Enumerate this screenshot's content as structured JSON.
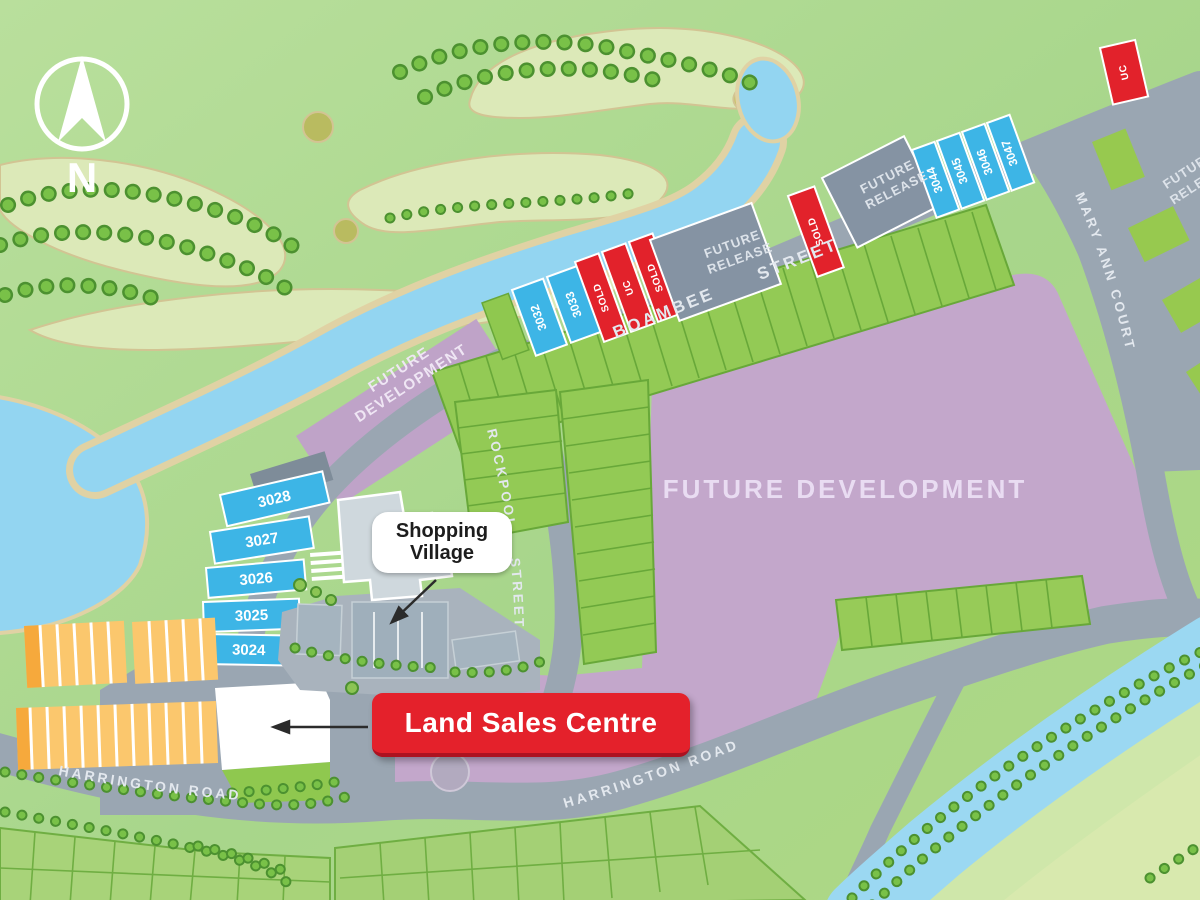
{
  "map": {
    "compass_label": "N",
    "streets": {
      "boambee": "BOAMBEE STREET",
      "mary_ann_court": "MARY ANN COURT",
      "rockpool": "ROCKPOOL STREET",
      "harrington_west": "HARRINGTON ROAD",
      "harrington_east": "HARRINGTON ROAD"
    },
    "areas": {
      "future_development_west": {
        "line1": "FUTURE",
        "line2": "DEVELOPMENT"
      },
      "future_development_main": "FUTURE DEVELOPMENT",
      "future_release_block1": {
        "line1": "FUTURE",
        "line2": "RELEASE"
      },
      "future_release_block2": {
        "line1": "FUTURE",
        "line2": "RELEASE"
      },
      "future_release_edge": {
        "line1": "FUTURE",
        "line2": "RELEASE"
      }
    },
    "callouts": {
      "shopping_village": {
        "line1": "Shopping",
        "line2": "Village"
      },
      "land_sales_centre": "Land Sales Centre"
    },
    "lots": {
      "hillside": [
        "3028",
        "3027",
        "3026",
        "3025",
        "3024"
      ],
      "boambee_south_blue": [
        "3032",
        "3033"
      ],
      "boambee_status": [
        "SOLD",
        "UC",
        "SOLD"
      ],
      "boambee_sold_east": "SOLD",
      "boambee_north_blue": [
        "3044",
        "3045",
        "3046",
        "3047"
      ],
      "north_under_construction": "UC"
    },
    "colors": {
      "lot_available_blue": "#3db5e6",
      "lot_sold_red": "#e2222b",
      "future_release_grey": "#8593a3",
      "future_development_purple": "#c3a7cb",
      "land_sales_red": "#e4212b",
      "road_grey": "#9aa6b2",
      "water_blue": "#93d5f1",
      "lot_yellow": "#fbc76d",
      "lot_orange": "#f6a93c"
    }
  }
}
